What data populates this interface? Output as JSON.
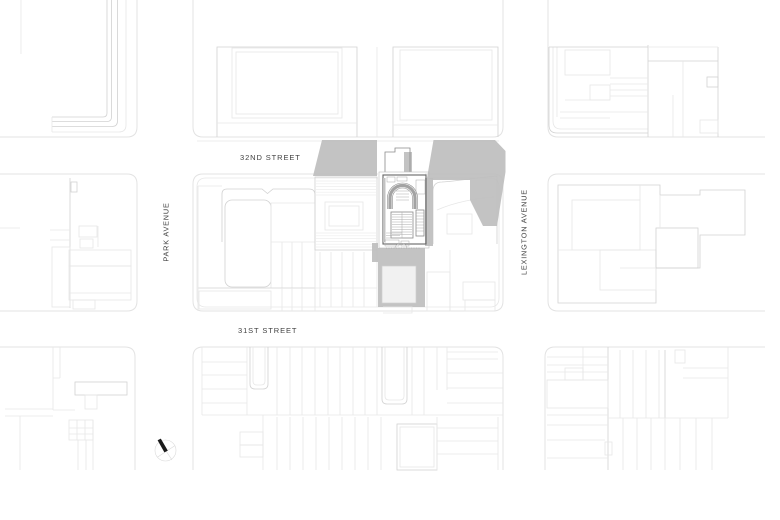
{
  "meta": {
    "kind": "architectural-site-plan",
    "area": "Manhattan block plan"
  },
  "labels": {
    "street_32nd": "32ND STREET",
    "street_31st": "31ST STREET",
    "avenue_park": "PARK AVENUE",
    "avenue_lexington": "LEXINGTON AVENUE"
  },
  "compass": {
    "type": "north-arrow",
    "needle_direction": "northwest"
  },
  "colors": {
    "background": "#ffffff",
    "curb_line": "#e3e3e3",
    "building_line": "#d2d2d2",
    "building_line_faint": "#e7e7e7",
    "plan_line": "#666666",
    "shadow_fill": "#bdbdbd",
    "label_text": "#414141",
    "north_needle": "#1b1b1b"
  }
}
